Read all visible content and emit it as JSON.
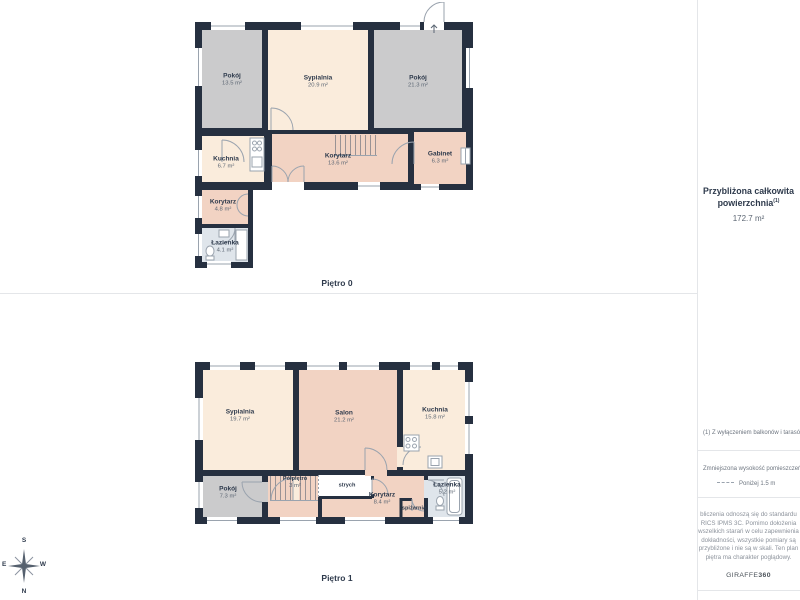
{
  "floor0": {
    "label": "Piętro 0",
    "rooms": [
      {
        "name": "Pokój",
        "area": "13.5 m²"
      },
      {
        "name": "Sypialnia",
        "area": "20.9 m²"
      },
      {
        "name": "Pokój",
        "area": "21.3 m²"
      },
      {
        "name": "Kuchnia",
        "area": "6.7 m²"
      },
      {
        "name": "Korytarz",
        "area": "13.6 m²"
      },
      {
        "name": "Gabinet",
        "area": "6.3 m²"
      },
      {
        "name": "Korytarz",
        "area": "4.8 m²"
      },
      {
        "name": "Łazienka",
        "area": "4.1 m²"
      }
    ]
  },
  "floor1": {
    "label": "Piętro 1",
    "rooms": [
      {
        "name": "Sypialnia",
        "area": "19.7 m²"
      },
      {
        "name": "Salon",
        "area": "21.2 m²"
      },
      {
        "name": "Kuchnia",
        "area": "15.8 m²"
      },
      {
        "name": "Pokój",
        "area": "7.3 m²"
      },
      {
        "name": "Półpiętro",
        "area": "3 m²"
      },
      {
        "name": "strych",
        "area": ""
      },
      {
        "name": "Korytarz",
        "area": "8.4 m²"
      },
      {
        "name": "spiżarnia",
        "area": ""
      },
      {
        "name": "Łazienka",
        "area": "5.2 m²"
      }
    ]
  },
  "sidebar": {
    "area_title_line1": "Przybliżona całkowita",
    "area_title_line2": "powierzchnia",
    "area_title_sup": "(1)",
    "area_value": "172.7 m²",
    "footnote": "(1) Z wyłączeniem balkonów i tarasów",
    "legend_title": "Zmniejszona wysokość pomieszczeń",
    "legend_item": "Poniżej 1.5 m",
    "disclaimer_lines": [
      "bliczenia odnoszą się do standardu",
      "RICS IPMS 3C. Pomimo dołożenia",
      "wszelkich starań w celu zapewnienia",
      "dokładności, wszystkie pomiary są",
      "przybliżone i nie są w skali. Ten plan",
      "piętra ma charakter poglądowy."
    ],
    "brand_name": "GIRAFFE",
    "brand_suffix": "360"
  },
  "compass": {
    "n": "N",
    "s": "S",
    "e": "E",
    "w": "W"
  },
  "colors": {
    "wall": "#263040",
    "room_gray": "#cbcbcc",
    "room_cream": "#faecdc",
    "room_pink": "#f2d3c3",
    "room_blue": "#dfe5eb",
    "line_gray": "#9aa3ae"
  }
}
